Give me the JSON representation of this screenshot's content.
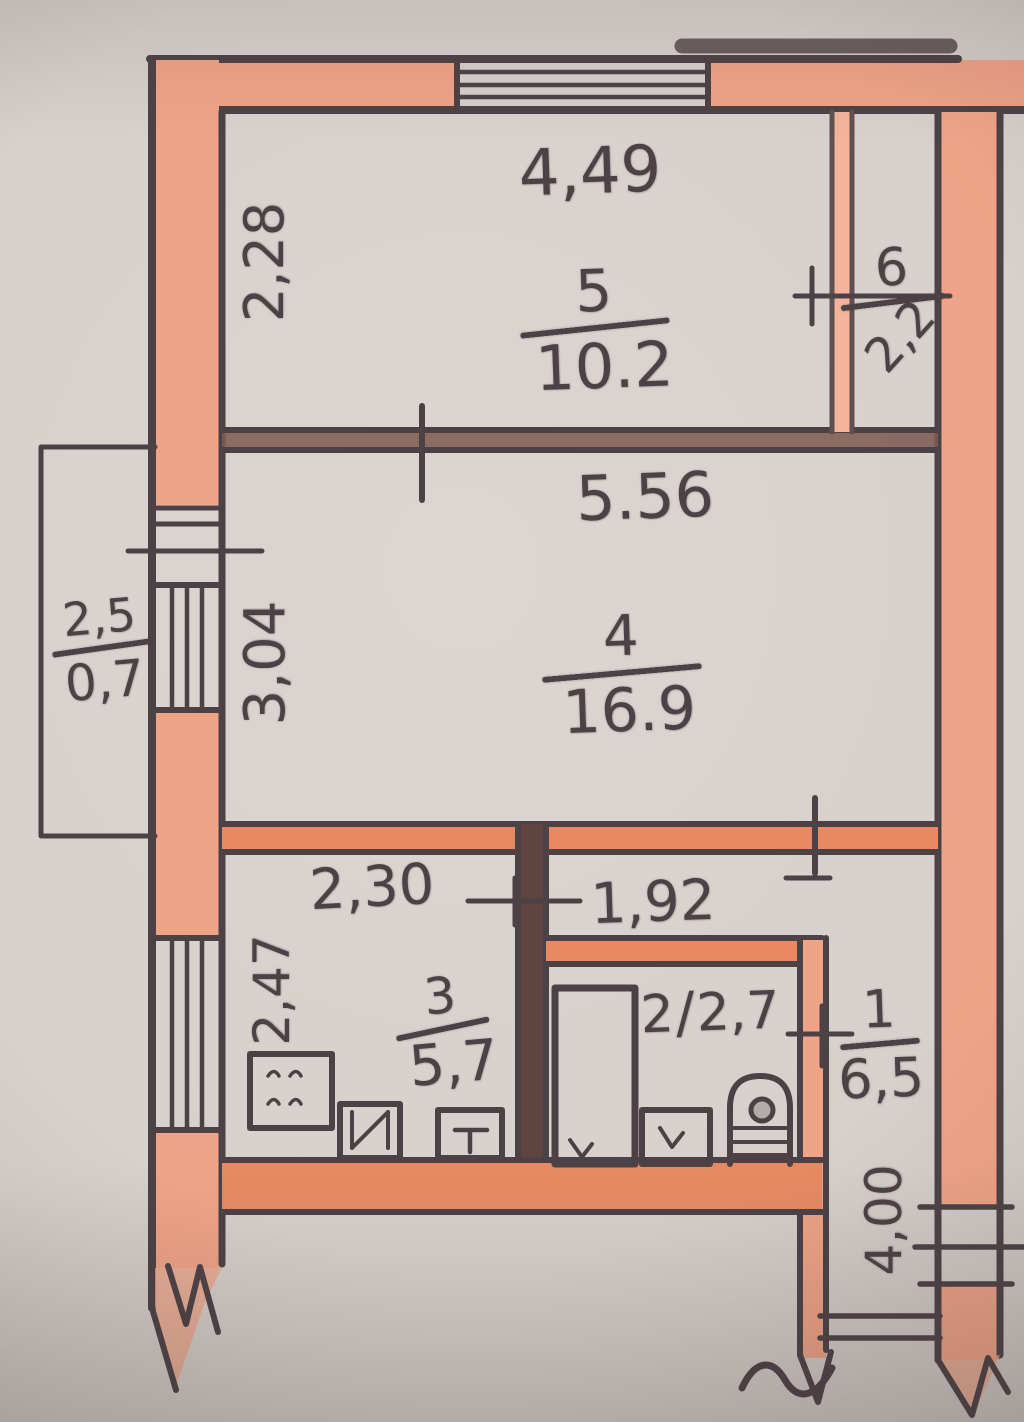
{
  "rooms": {
    "room5": {
      "number": "5",
      "area": "10.2"
    },
    "room6": {
      "number": "6",
      "area": "2,2"
    },
    "room4": {
      "number": "4",
      "area": "16.9"
    },
    "room3": {
      "number": "3",
      "area": "5,7"
    },
    "room2": {
      "number": "2",
      "separator": "/",
      "area": "2,7"
    },
    "room1": {
      "number": "1",
      "area": "6,5"
    }
  },
  "dimensions": {
    "room5_width": "4,49",
    "room5_depth": "2,28",
    "room4_width": "5.56",
    "room4_depth": "3,04",
    "room3_width": "2,30",
    "room3_depth": "2,47",
    "room2_width": "1,92",
    "balcony_width": "2,5",
    "balcony_depth": "0,7",
    "hall_depth": "4,00"
  },
  "fixtures": {
    "kitchen": [
      "stove-icon",
      "sink-icon",
      "counter-icon"
    ],
    "bathroom": [
      "bathtub-icon",
      "washbasin-icon",
      "toilet-icon"
    ]
  },
  "colors": {
    "paper": "#d7d1cd",
    "wall_fill": "#f0a487",
    "wall_fill_deep": "#e78a63",
    "wall_fill_light": "#f2b49a",
    "wall_dark": "#7d5950",
    "wall_darkest": "#5f4440",
    "ink": "#4c4145",
    "ink_soft": "#5d5154"
  }
}
